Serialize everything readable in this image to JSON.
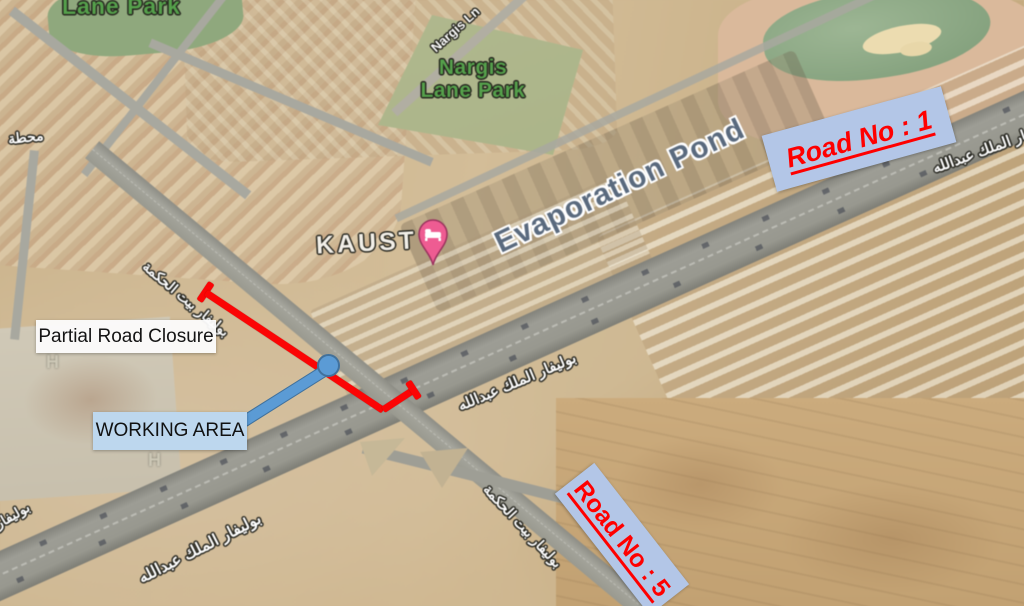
{
  "map": {
    "labels": {
      "lane_park_top": "Lane Park",
      "nargis_park_line1": "Nargis",
      "nargis_park_line2": "Lane Park",
      "nargis_ln": "Nargis Ln",
      "station_ar": "محطة",
      "kaust": "KAUST",
      "evaporation_pond": "Evaporation Pond",
      "helipad_h": "H",
      "blvd_bayt_al_hikma_ar": "بوليفار بيت الحكمة",
      "blvd_king_abdullah_ar": "بوليفار الملك عبدالله"
    }
  },
  "annotations": {
    "road1_label": "Road No : 1",
    "road5_label": "Road No : 5",
    "partial_closure_label": "Partial Road Closure",
    "working_area_label": "WORKING AREA"
  },
  "colors": {
    "annotation_box_bg": "#b3c6e7",
    "working_area_bg": "#bdd7ee",
    "road_number_text": "#ff0000",
    "closure_line": "#fb0505",
    "arrow_blue": "#5b9bd5",
    "kaust_pin_pink": "#ee5c92",
    "park_text_green": "#55a04b",
    "pond_text": "#5a6a7e"
  }
}
